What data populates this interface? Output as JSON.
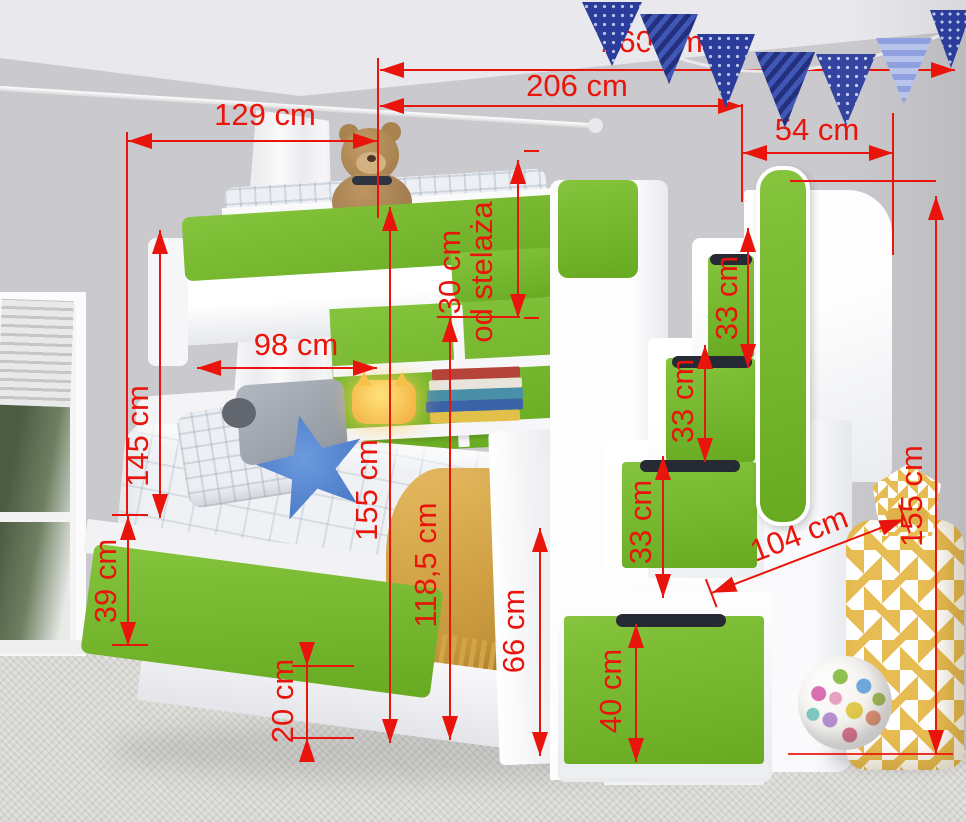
{
  "meta": {
    "view": "kids bunk bed with staircase drawers and trundle - product photo with dimension callouts"
  },
  "colors": {
    "dimension_red": "#e9140b",
    "furniture_green": "#74b62d",
    "flag_navy": "#2f3f9e",
    "wall_gray": "#cac9cd",
    "blanket_yellow": "#d9a94b",
    "bag_yellow": "#e7bc52"
  },
  "dims": {
    "d260": "260 cm",
    "d206": "206 cm",
    "d129": "129 cm",
    "d54": "54 cm",
    "d30_line1": "30 cm",
    "d30_line2": "od stelaża",
    "d33a": "33 cm",
    "d33b": "33 cm",
    "d33c": "33 cm",
    "d98": "98 cm",
    "d145": "145 cm",
    "d155_center": "155 cm",
    "d118": "118,5 cm",
    "d39": "39 cm",
    "d66": "66 cm",
    "d20": "20 cm",
    "d104": "104 cm",
    "d155_right": "155 cm",
    "d40": "40 cm"
  }
}
